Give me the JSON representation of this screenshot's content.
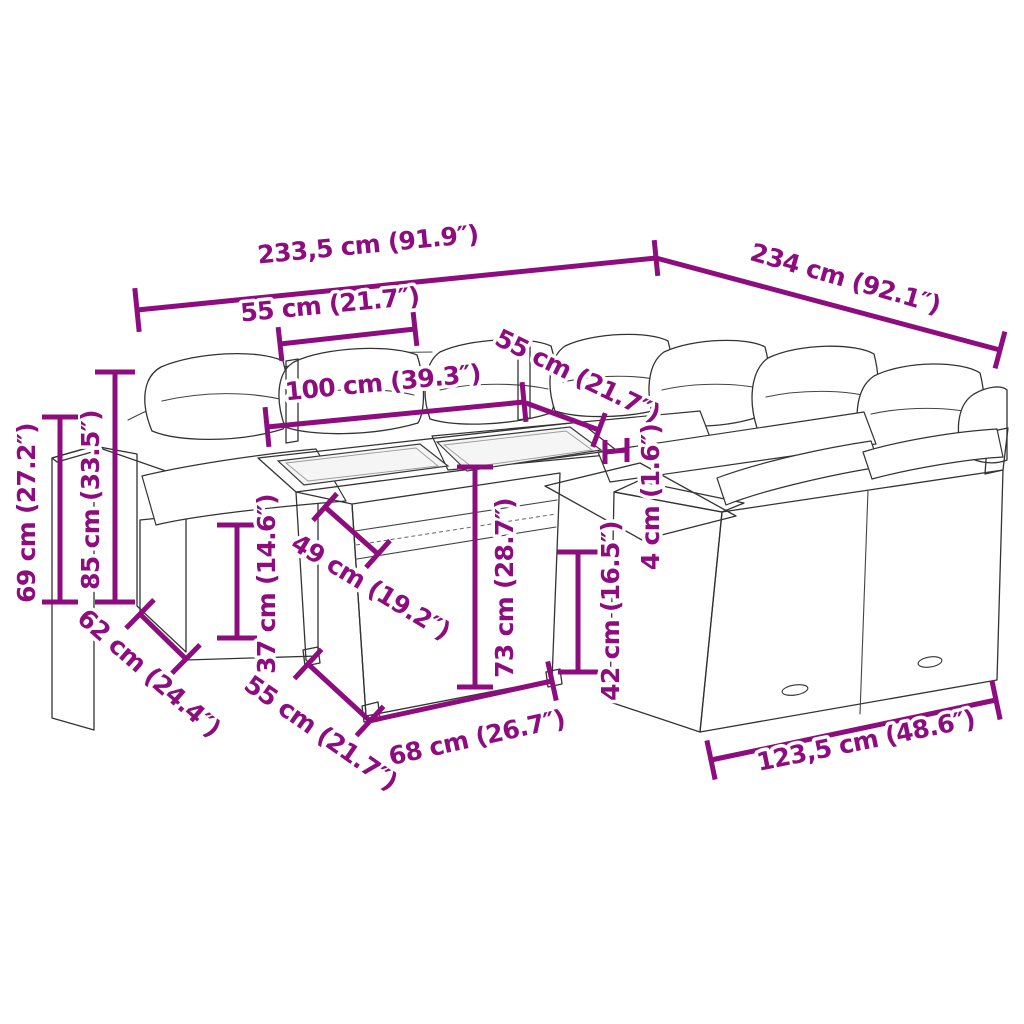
{
  "colors": {
    "dimension": "#8d0c7e",
    "drawing_outline": "#333333",
    "background": "#ffffff"
  },
  "illustration": {
    "subject": "garden-lounge-set-line-drawing"
  },
  "dimensions": [
    {
      "id": "back-width",
      "label": "233,5 cm (91.9″)",
      "line": [
        137,
        310,
        656,
        258
      ],
      "caps": [
        44,
        36
      ],
      "text": [
        368,
        246,
        -5.5
      ]
    },
    {
      "id": "right-width",
      "label": "234 cm (92.1″)",
      "line": [
        656,
        258,
        1000,
        350
      ],
      "caps": [
        0,
        38
      ],
      "text": [
        845,
        280,
        16
      ]
    },
    {
      "id": "seat-top-55",
      "label": "55 cm (21.7″)",
      "line": [
        280,
        344,
        415,
        329
      ],
      "caps": [
        34,
        34
      ],
      "text": [
        330,
        306,
        -5.5
      ]
    },
    {
      "id": "table-top-100",
      "label": "100 cm (39.3″)",
      "line": [
        267,
        427,
        524,
        402
      ],
      "caps": [
        40,
        40
      ],
      "text": [
        383,
        384,
        -5.5
      ]
    },
    {
      "id": "seat-mid-55",
      "label": "55 cm (21.7″)",
      "line": [
        526,
        403,
        599,
        430
      ],
      "caps": [
        0,
        36
      ],
      "text": [
        577,
        377,
        26
      ]
    },
    {
      "id": "glass-depth-49",
      "label": "49 cm (19.2″)",
      "line": [
        325,
        507,
        378,
        554
      ],
      "caps": [
        36,
        36
      ],
      "text": [
        370,
        588,
        31
      ]
    },
    {
      "id": "table-height-73",
      "label": "73 cm (28.7″)",
      "line": [
        475,
        467,
        475,
        687
      ],
      "caps": [
        36,
        36
      ],
      "text": [
        506,
        588,
        -90
      ]
    },
    {
      "id": "seat-height-37",
      "label": "37 cm (14.6″)",
      "line": [
        237,
        525,
        237,
        638
      ],
      "caps": [
        40,
        40
      ],
      "text": [
        268,
        584,
        -90
      ]
    },
    {
      "id": "total-height-85",
      "label": "85 cm (33.5″)",
      "line": [
        115,
        372,
        115,
        602
      ],
      "caps": [
        40,
        40
      ],
      "text": [
        92,
        500,
        -90
      ]
    },
    {
      "id": "arm-height-69",
      "label": "69 cm (27.2″)",
      "line": [
        60,
        417,
        60,
        602
      ],
      "caps": [
        36,
        36
      ],
      "text": [
        28,
        513,
        -90
      ]
    },
    {
      "id": "depth-62",
      "label": "62 cm (24.4″)",
      "line": [
        140,
        614,
        186,
        659
      ],
      "caps": [
        40,
        40
      ],
      "text": [
        148,
        674,
        41
      ]
    },
    {
      "id": "table-side-55",
      "label": "55 cm (21.7″)",
      "line": [
        308,
        664,
        370,
        721
      ],
      "caps": [
        40,
        40
      ],
      "text": [
        320,
        734,
        35
      ]
    },
    {
      "id": "table-front-68",
      "label": "68 cm (26.7″)",
      "line": [
        369,
        721,
        552,
        681
      ],
      "caps": [
        0,
        40
      ],
      "text": [
        477,
        739,
        -12.5
      ]
    },
    {
      "id": "bench-height-42",
      "label": "42 cm (16.5″)",
      "line": [
        578,
        552,
        578,
        672
      ],
      "caps": [
        42,
        40
      ],
      "text": [
        612,
        611,
        -90
      ]
    },
    {
      "id": "glass-thick-4",
      "label": "4 cm (1.6″)",
      "hmark": [
        605,
        440,
        627,
        464
      ],
      "text": [
        652,
        497,
        -90
      ]
    },
    {
      "id": "bench-width-123",
      "label": "123,5 cm (48.6″)",
      "line": [
        711,
        760,
        996,
        700
      ],
      "caps": [
        40,
        40
      ],
      "text": [
        866,
        742,
        -11.5
      ]
    }
  ]
}
